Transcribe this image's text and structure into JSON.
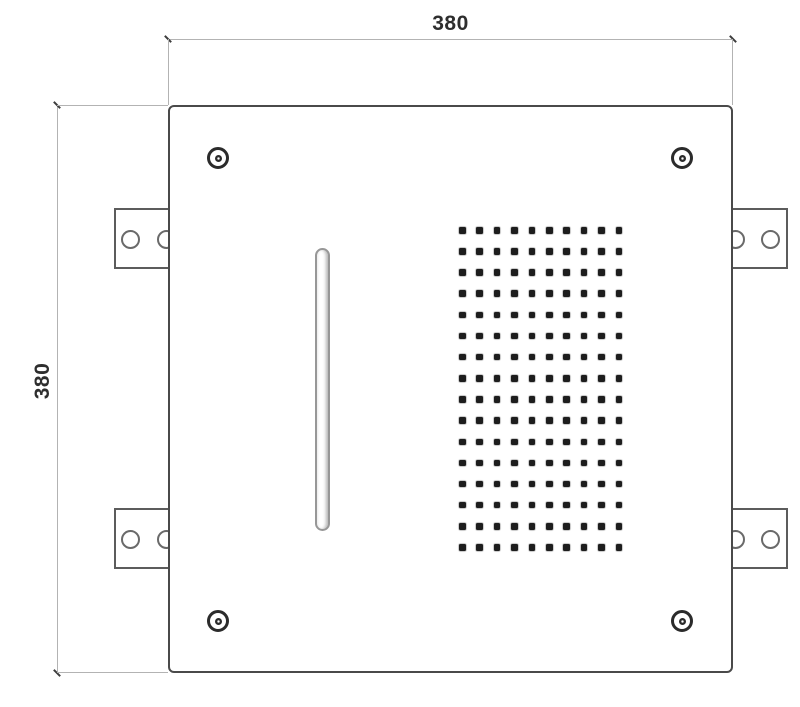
{
  "drawing": {
    "dim_width": {
      "label": "380"
    },
    "dim_height": {
      "label": "380"
    },
    "panel": {
      "corner_screw_count": 4,
      "bracket_count": 4,
      "holes_per_bracket": 2,
      "waterfall_slot": {
        "shape": "vertical-pill"
      },
      "nozzle_grid": {
        "rows": 16,
        "cols": 10,
        "col_spacing": 17.4,
        "row_spacing": 21.15,
        "dot_size": 6.5
      }
    },
    "colors": {
      "background": "#ffffff",
      "panel_outline": "#4a4a4a",
      "dimension_line": "#b3b3b3",
      "bracket_outline": "#5c5c5c",
      "screw_outline": "#2b2b2b",
      "nozzle_dot": "#1d1d1d",
      "label_text": "#2e2e2e"
    }
  }
}
